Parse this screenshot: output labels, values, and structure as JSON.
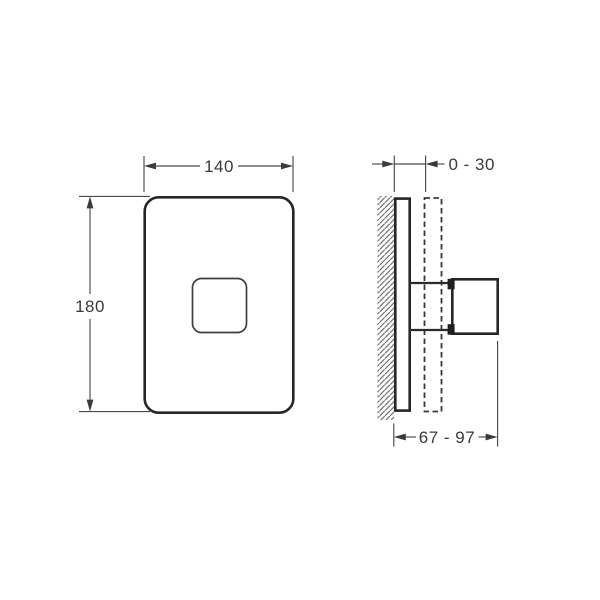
{
  "page": {
    "background_color": "#ffffff",
    "content_type": "technical dimension drawing with front view and side view"
  },
  "front_view": {
    "width_label": "140",
    "height_label": "180"
  },
  "side_view": {
    "wall_projection_label": "0 - 30",
    "total_depth_label": "67 - 97"
  },
  "colors": {
    "outline": "#262626",
    "dimension_lines": "#4a4a4a",
    "text": "#3a3a3a",
    "hatch": "#585858",
    "background": "#ffffff"
  }
}
